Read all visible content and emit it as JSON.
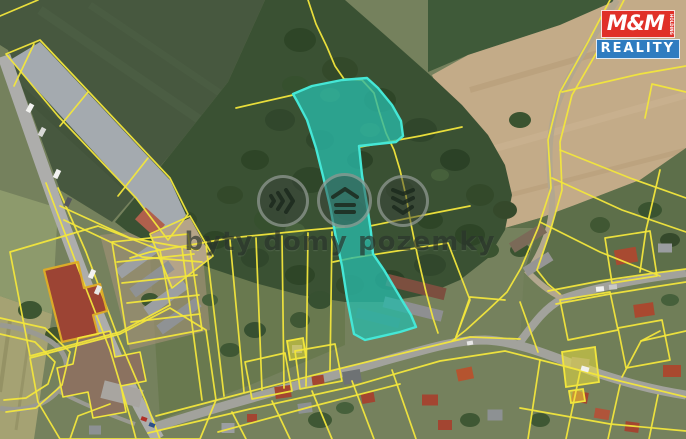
{
  "map": {
    "description_labels": [],
    "highlighted_parcel": "selected-land-parcel"
  },
  "watermark": {
    "text": "byty domy pozemky",
    "icons": [
      "flats-chevrons-icon",
      "house-roof-icon",
      "land-layers-icon"
    ]
  },
  "logo": {
    "name": "M&M",
    "holding": "HOLDING",
    "reality": "REALITY"
  },
  "colors": {
    "parcel_line": "#f2e63c",
    "parcel_fill": "#f2e63c",
    "highlight_fill": "#29b9a8",
    "highlight_border": "#45e7d6",
    "logo_red": "#e03028",
    "logo_blue": "#2f7cc0",
    "logo_text": "#ffffff",
    "watermark_color": "#2a342c"
  }
}
